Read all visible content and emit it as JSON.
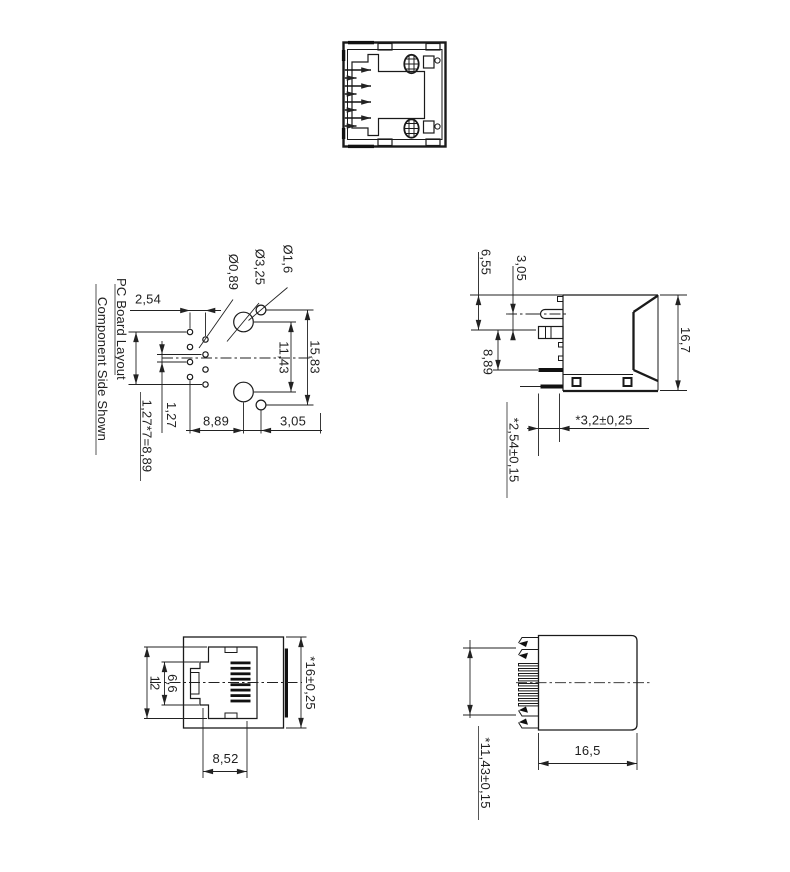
{
  "drawing": {
    "colors": {
      "line": "#1a1a1a",
      "dim": "#222222",
      "background": "#ffffff"
    },
    "pcb_layout": {
      "title": "PC Board Layout",
      "subtitle": "Component Side Shown",
      "dim_col_pitch": "2,54",
      "dim_hole_dia": "Ø0,89",
      "dim_boss_dia": "Ø3,25",
      "dim_pin_dia": "Ø1,6",
      "dim_span_outer": "15,83",
      "dim_span_boss": "11,43",
      "dim_row_pitch": "1,27",
      "dim_row_total": "1,27*7=8,89",
      "dim_offset_boss": "8,89",
      "dim_offset_pin": "3,05"
    },
    "side_view": {
      "dim_top_to_latch": "6,55",
      "dim_latch_to_block": "3,05",
      "dim_block_to_tab": "8,89",
      "dim_height": "16,7",
      "dim_tab_stagger": "*2,54±0,15",
      "dim_tab_length": "*3,2±0,25"
    },
    "front_view": {
      "dim_opening_height": "12",
      "dim_latch_width": "6,6",
      "dim_opening_width": "8,52",
      "dim_body_height": "*16±0,25"
    },
    "rear_view": {
      "dim_body_depth": "16,5",
      "dim_contact_span": "*11,43±0,15"
    }
  }
}
